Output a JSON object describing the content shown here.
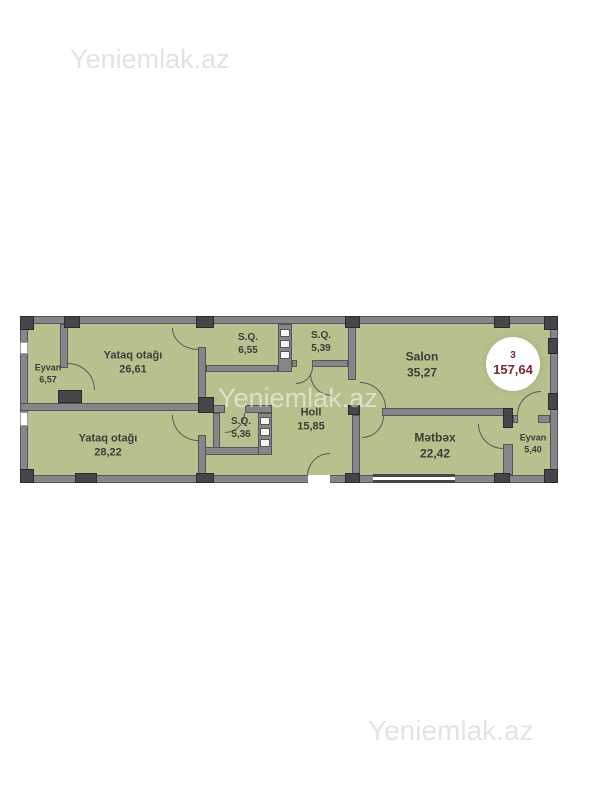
{
  "watermarks": {
    "top": "Yeniemlak.az",
    "middle": "Yeniemlak.az",
    "bottom": "Yeniemlak.az"
  },
  "badge": {
    "floor": "3",
    "total_area": "157,64"
  },
  "rooms": [
    {
      "id": "eyvan-left",
      "name": "Eyvan",
      "area": "6,57"
    },
    {
      "id": "bedroom-1",
      "name": "Yataq otağı",
      "area": "26,61"
    },
    {
      "id": "sq-1",
      "name": "S.Q.",
      "area": "6,55"
    },
    {
      "id": "sq-2",
      "name": "S.Q.",
      "area": "5,39"
    },
    {
      "id": "salon",
      "name": "Salon",
      "area": "35,27"
    },
    {
      "id": "bedroom-2",
      "name": "Yataq otağı",
      "area": "28,22"
    },
    {
      "id": "sq-3",
      "name": "S.Q.",
      "area": "5,36"
    },
    {
      "id": "holl",
      "name": "Holl",
      "area": "15,85"
    },
    {
      "id": "metbex",
      "name": "Mətbəx",
      "area": "22,42"
    },
    {
      "id": "eyvan-right",
      "name": "Eyvan",
      "area": "5,40"
    }
  ],
  "colors": {
    "floor_fill": "#b6c18d",
    "wall": "#85858a",
    "wall_dark": "#45454a",
    "label_text": "#3d3d3d",
    "badge_text": "#7c2634",
    "watermark": "#e3e3e5"
  }
}
